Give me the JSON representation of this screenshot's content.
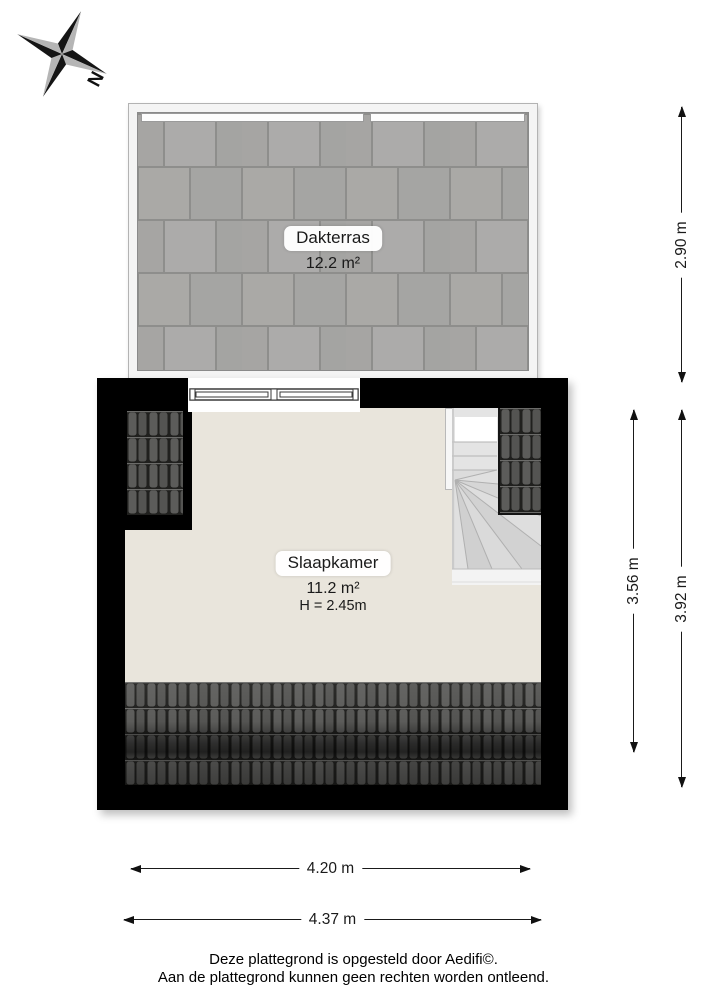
{
  "compass": {
    "north_label": "N"
  },
  "rooms": {
    "dakterras": {
      "name": "Dakterras",
      "area": "12.2 m²"
    },
    "slaapkamer": {
      "name": "Slaapkamer",
      "area": "11.2 m²",
      "ceiling_height": "H = 2.45m"
    }
  },
  "dimensions": {
    "dakterras_depth": "2.90 m",
    "slaapkamer_depth_inner": "3.56 m",
    "slaapkamer_depth_outer": "3.92 m",
    "slaapkamer_width_inner": "4.20 m",
    "slaapkamer_width_outer": "4.37 m"
  },
  "footer": {
    "line1": "Deze plattegrond is opgesteld door Aedifi©.",
    "line2": "Aan de plattegrond kunnen geen rechten worden ontleend."
  },
  "colors": {
    "wall": "#000000",
    "floor": "#e9e5dc",
    "terrace_tile": "#a9a8a6",
    "terrace_grout": "#8e8e8c",
    "roof_tile": "#565654",
    "dimension_line": "#1a1a1a"
  }
}
